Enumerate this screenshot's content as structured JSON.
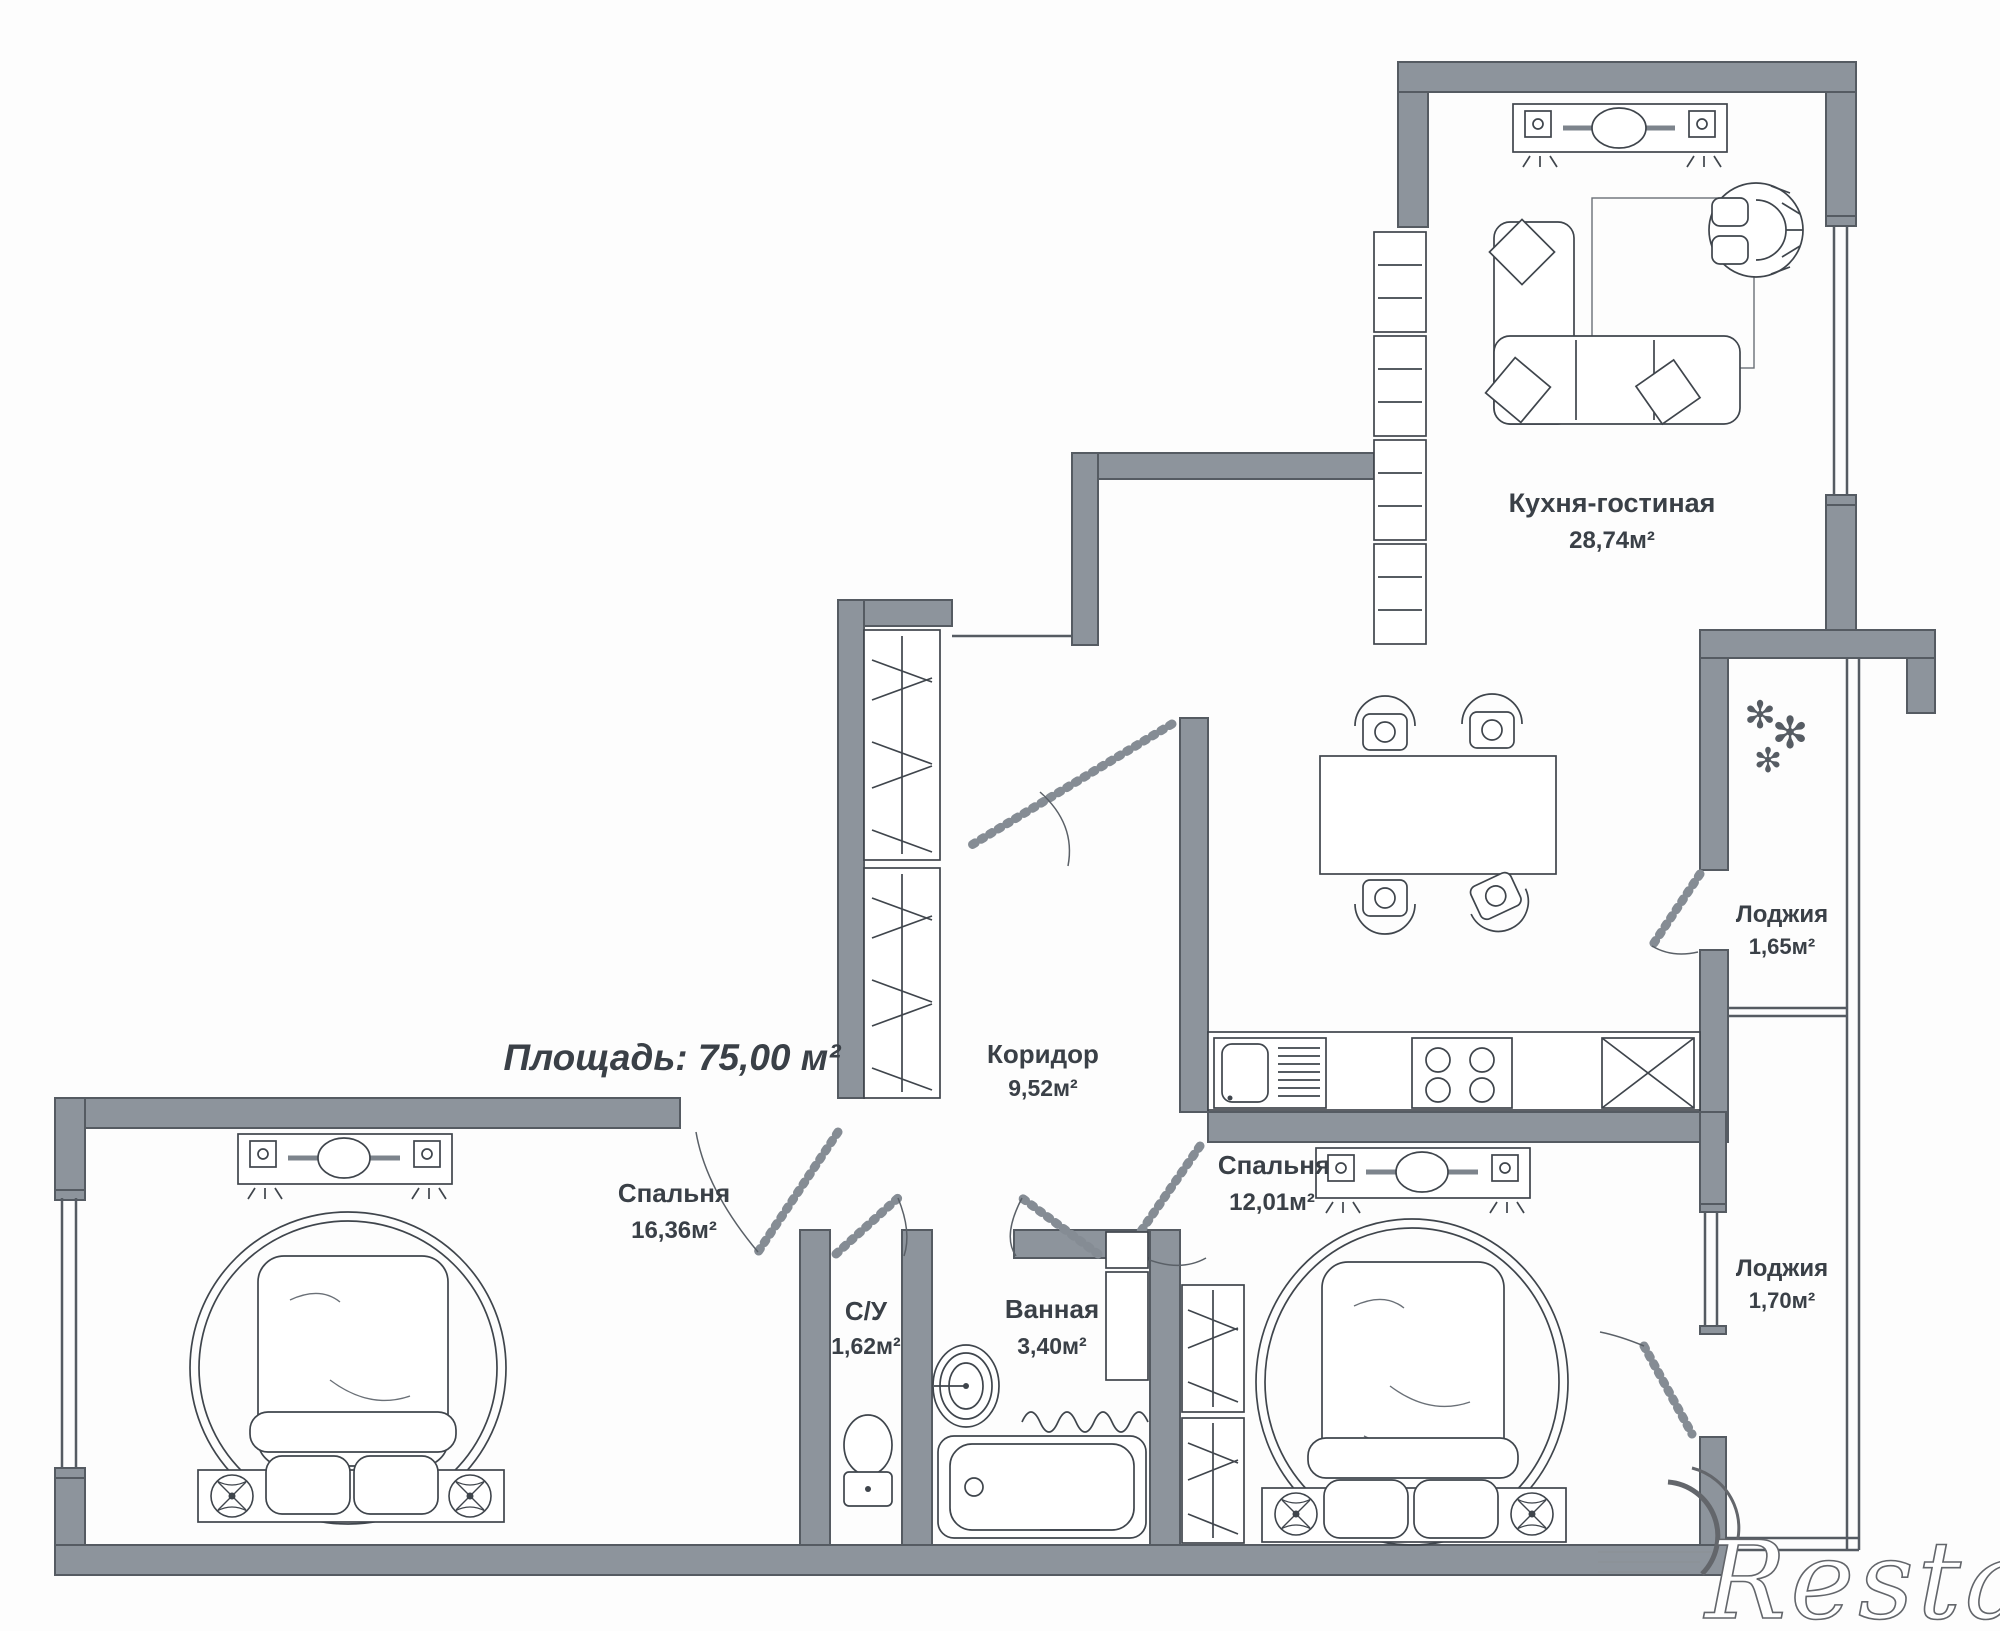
{
  "plan": {
    "title_area": "Площадь: 75,00 м²",
    "rooms": [
      {
        "name": "Кухня-гостиная",
        "area": "28,74м²"
      },
      {
        "name": "Коридор",
        "area": "9,52м²"
      },
      {
        "name": "Лоджия",
        "area": "1,65м²"
      },
      {
        "name": "Спальня",
        "area": "16,36м²"
      },
      {
        "name": "Спальня",
        "area": "12,01м²"
      },
      {
        "name": "С/У",
        "area": "1,62м²"
      },
      {
        "name": "Ванная",
        "area": "3,40м²"
      },
      {
        "name": "Лоджия",
        "area": "1,70м²"
      }
    ],
    "watermark": "Restate",
    "icons": {
      "plant": "✻"
    },
    "colors": {
      "wall": "#8d949c",
      "wallEdge": "#555b62",
      "line": "#3f454c",
      "text": "#3a4047",
      "bg": "#fdfdfd"
    }
  }
}
